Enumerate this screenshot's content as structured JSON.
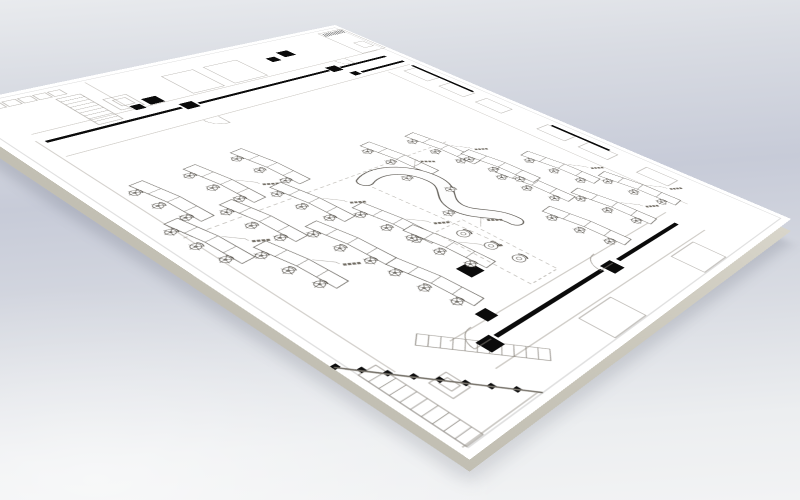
{
  "scene": {
    "title": "office-floor-plan-board-render",
    "description": "Perspective 3D render of a black-and-white office floor plan drawing on a thin white board over a gray-blue studio backdrop",
    "colors": {
      "bg_top": "#e9ebee",
      "bg_band": "#c7cbd8",
      "bg_mid": "#d8dbe2",
      "bg_bottom": "#f2f3f4",
      "board_face": "#ffffff",
      "board_edge_light": "#d8d5ca",
      "board_edge_dark": "#c2bfb3",
      "ink": "#55514a",
      "ink_soft": "#9a958c",
      "wall_black": "#0b0b0b",
      "frame_gray": "#cccccc",
      "label_gray": "#726d64"
    }
  },
  "plan": {
    "width": 1000,
    "height": 780,
    "border": [
      12,
      12,
      976,
      756
    ],
    "desks": [
      [
        350,
        600,
        -7,
        1
      ],
      [
        350,
        685,
        -7,
        0
      ],
      [
        345,
        515,
        -7,
        0
      ],
      [
        460,
        540,
        -7,
        1
      ],
      [
        460,
        625,
        -7,
        0
      ],
      [
        460,
        710,
        -7,
        1
      ],
      [
        570,
        490,
        -7,
        1
      ],
      [
        570,
        575,
        -7,
        0
      ],
      [
        570,
        660,
        -7,
        1
      ],
      [
        605,
        150,
        -7,
        1
      ],
      [
        615,
        235,
        -7,
        0
      ],
      [
        725,
        105,
        -7,
        1
      ],
      [
        732,
        192,
        -7,
        1
      ],
      [
        740,
        278,
        -7,
        0
      ],
      [
        450,
        255,
        -7,
        1
      ],
      [
        435,
        340,
        -7,
        0
      ],
      [
        545,
        228,
        -7,
        0
      ],
      [
        655,
        480,
        -7,
        1
      ],
      [
        700,
        560,
        -7,
        0
      ]
    ],
    "black_walls": [
      [
        176,
        40,
        7,
        118
      ],
      [
        176,
        186,
        7,
        282
      ],
      [
        176,
        500,
        7,
        225
      ],
      [
        212,
        28,
        7,
        112
      ],
      [
        887,
        168,
        7,
        164
      ],
      [
        887,
        372,
        7,
        228
      ],
      [
        240,
        28,
        150,
        6
      ],
      [
        566,
        28,
        120,
        6
      ]
    ],
    "black_columns": [
      [
        64,
        184,
        26
      ],
      [
        78,
        226,
        20
      ],
      [
        166,
        160,
        24
      ],
      [
        166,
        472,
        24
      ],
      [
        120,
        506,
        26
      ],
      [
        134,
        544,
        18
      ],
      [
        883,
        342,
        24
      ],
      [
        883,
        604,
        24
      ],
      [
        766,
        498,
        26
      ],
      [
        846,
        564,
        20
      ],
      [
        206,
        146,
        16
      ]
    ],
    "thin_lines": [
      [
        148,
        30,
        148,
        728
      ],
      [
        234,
        30,
        234,
        728
      ],
      [
        862,
        150,
        862,
        648
      ],
      [
        928,
        150,
        928,
        648
      ],
      [
        240,
        96,
        870,
        96
      ],
      [
        20,
        565,
        145,
        565
      ],
      [
        170,
        735,
        860,
        735
      ]
    ],
    "rooms": [
      [
        24,
        6,
        122,
        62
      ],
      [
        96,
        18,
        30,
        24
      ],
      [
        58,
        296,
        84,
        70
      ],
      [
        58,
        388,
        84,
        62
      ],
      [
        934,
        198,
        52,
        64
      ],
      [
        934,
        420,
        52,
        72
      ],
      [
        252,
        34,
        58,
        32
      ],
      [
        338,
        34,
        58,
        32
      ],
      [
        424,
        34,
        58,
        32
      ],
      [
        560,
        34,
        58,
        32
      ],
      [
        646,
        34,
        58,
        32
      ],
      [
        760,
        34,
        58,
        32
      ],
      [
        26,
        612,
        20,
        20
      ],
      [
        26,
        636,
        20,
        20
      ],
      [
        26,
        660,
        20,
        20
      ],
      [
        26,
        684,
        20,
        20
      ],
      [
        26,
        708,
        20,
        20
      ],
      [
        92,
        540,
        48,
        40
      ],
      [
        102,
        548,
        26,
        22
      ],
      [
        896,
        694,
        34,
        28
      ],
      [
        903,
        700,
        18,
        14
      ]
    ],
    "dashed_lines": [
      [
        505,
        240,
        505,
        738
      ],
      [
        522,
        452,
        762,
        428
      ]
    ],
    "door_arcs": [
      [
        890,
        345,
        30,
        90
      ],
      [
        890,
        608,
        30,
        90
      ],
      [
        236,
        474,
        28,
        0
      ],
      [
        150,
        118,
        26,
        0
      ]
    ],
    "stairs": [
      {
        "x": 56,
        "y": 596,
        "w": 112,
        "h": 40,
        "n": 9,
        "rot": 0
      },
      {
        "x": 828,
        "y": 666,
        "w": 152,
        "h": 22,
        "n": 11,
        "rot": -38.5
      },
      {
        "x": 838,
        "y": 742,
        "w": 148,
        "h": 26,
        "n": 10,
        "rot": 0
      }
    ],
    "hatch_band": {
      "x": 28,
      "y": 10,
      "w": 16,
      "h": 54,
      "step": 5
    },
    "checker_band": {
      "x1": 812,
      "y1": 776,
      "x2": 988,
      "y2": 642,
      "n": 16,
      "s": 8
    },
    "corner_outline": "822,772 984,646 984,772",
    "corner_wall": [
      812,
      778,
      988,
      642
    ],
    "sofa": {
      "path": "M528,446 C506,404 532,360 578,357 C618,354 624,392 657,396 C692,400 700,358 736,360",
      "chairs": [
        [
          556,
          388
        ],
        [
          618,
          362
        ],
        [
          664,
          420
        ]
      ],
      "label_at": [
        520,
        330
      ]
    },
    "lounge": {
      "x": 688,
      "y": 418,
      "w": 162,
      "h": 58,
      "chairs": [
        [
          714,
          447
        ],
        [
          758,
          442
        ],
        [
          802,
          438
        ]
      ],
      "label_at": [
        700,
        392
      ]
    }
  }
}
